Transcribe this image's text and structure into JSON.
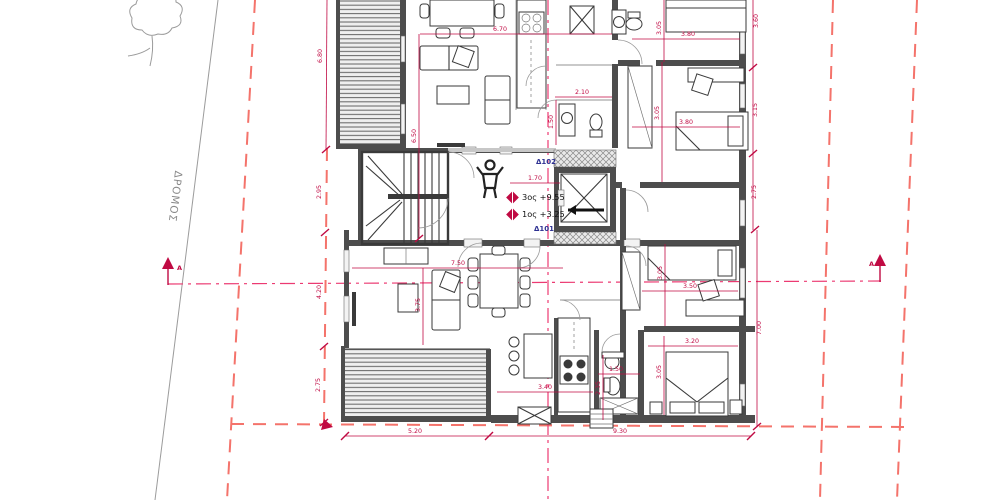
{
  "drawing": {
    "kind": "architectural floor plan (site + apartment level)",
    "road_label": "ΔΡΟΜΟΣ",
    "section_label": "A",
    "apartments": {
      "upper": "Δ102",
      "lower": "Δ101"
    },
    "levels": {
      "upper": "3ος +9.55",
      "lower": "1ος +3.25"
    }
  },
  "colors": {
    "dimension_red": "#c00a43",
    "boundary_dashed_red": "#f4736b",
    "centerline_pink": "#ec3a72",
    "wall_gray": "#4d4d4d",
    "apartment_label_navy": "#2e3192",
    "road_text_gray": "#8a8a8a"
  },
  "dims": {
    "living_top_w": "6.70",
    "br1_w": "3.80",
    "bath_top_w": "2.10",
    "br2_w": "3.80",
    "hall_w": "1.70",
    "living_bottom_w": "7.50",
    "br3_w": "3.50",
    "br4_w": "3.20",
    "kitchen_bottom_w": "3.40",
    "bath_bottom_w": "1.50",
    "plot_bottom_left": "5.20",
    "plot_bottom_right": "9.30",
    "setback_left_1": "6.80",
    "setback_left_2": "2.95",
    "setback_left_3": "4.20",
    "setback_left_4": "2.75",
    "living_top_h": "6.50",
    "living_bottom_h": "3.75",
    "kitchen_top_h": "1.50",
    "br1_h": "3.05",
    "br2_h": "3.05",
    "right_1": "3.60",
    "right_2": "3.15",
    "right_3": "2.75",
    "right_total": "7.00",
    "br3_h": "3.05",
    "br4_h": "3.05",
    "bath_bottom_h": "2.35"
  }
}
